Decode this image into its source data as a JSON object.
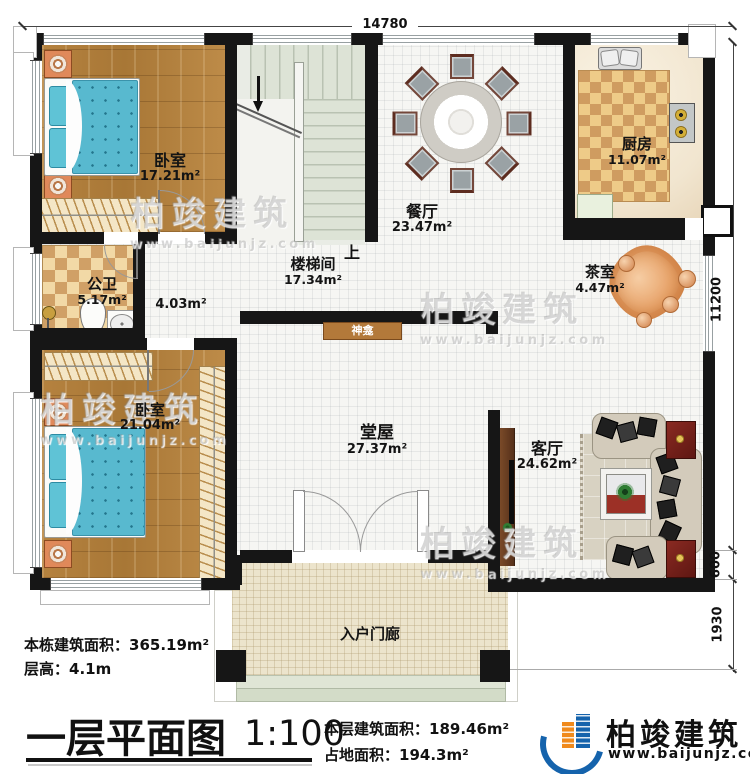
{
  "dimensions": {
    "width_top": "14780",
    "height_right": "11200",
    "right_step": "600",
    "porch_depth": "1930"
  },
  "rooms": {
    "bedroom1": {
      "name": "卧室",
      "area": "17.21m²"
    },
    "stairwell": {
      "name": "楼梯间",
      "area": "17.34m²",
      "direction": "上"
    },
    "dining": {
      "name": "餐厅",
      "area": "23.47m²"
    },
    "kitchen": {
      "name": "厨房",
      "area": "11.07m²"
    },
    "bathroom": {
      "name": "公卫",
      "area": "5.17m²"
    },
    "corridor": {
      "area": "4.03m²"
    },
    "tearoom": {
      "name": "茶室",
      "area": "4.47m²"
    },
    "bedroom2": {
      "name": "卧室",
      "area": "21.04m²"
    },
    "hall": {
      "name": "堂屋",
      "area": "27.37m²"
    },
    "shrine": {
      "name": "神龛"
    },
    "living": {
      "name": "客厅",
      "area": "24.62m²"
    },
    "porch": {
      "name": "入户门廊"
    }
  },
  "info": {
    "building_area_label": "本栋建筑面积：",
    "building_area_value": "365.19m²",
    "floor_height_label": "层高：",
    "floor_height_value": "4.1m",
    "floor_area_label": "本层建筑面积：",
    "floor_area_value": "189.46m²",
    "footprint_label": "占地面积：",
    "footprint_value": "194.3m²"
  },
  "titleblock": {
    "title": "一层平面图",
    "scale": "1:100"
  },
  "brand": {
    "name": "柏竣建筑",
    "website": "www.baijunjz.com"
  },
  "watermark": {
    "line1": "柏竣建筑",
    "line2": "www.baijunjz.com"
  },
  "colors": {
    "wall": "#161616",
    "wood_floor": "#b2803f",
    "checker_light": "#f2d9a6",
    "checker_dark": "#d0a066",
    "porch_tile": "#ece4cc",
    "bed_blue": "#58b9cf",
    "brand_blue": "#1563ac",
    "brand_orange": "#f08a1c"
  }
}
